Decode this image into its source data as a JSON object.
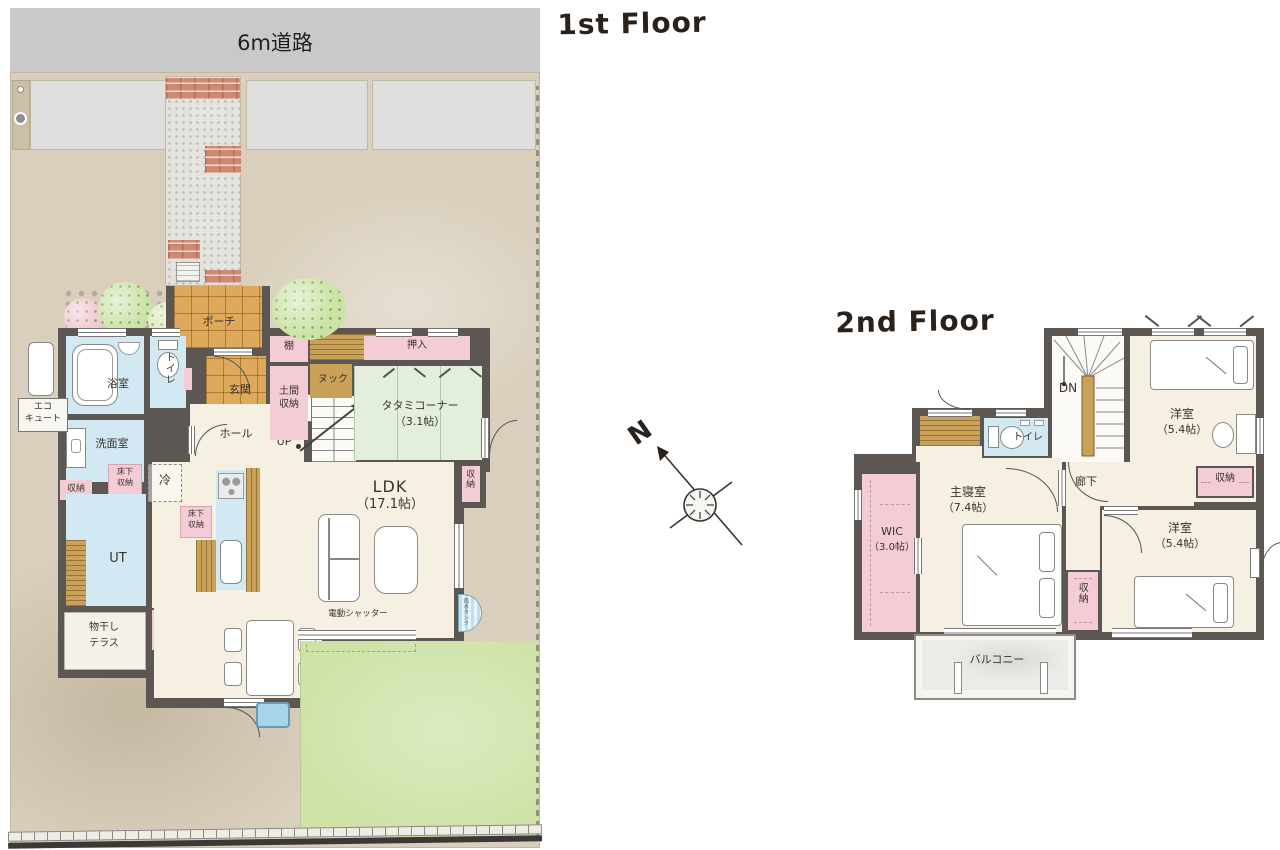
{
  "titles": {
    "floor1": "1st Floor",
    "floor2": "2nd Floor"
  },
  "site": {
    "road": "6m道路"
  },
  "colors": {
    "wall": "#5c5753",
    "water": "#d2e8f3",
    "closet_pink": "#f3ccd5",
    "tatami_green": "#e3efdc",
    "wood": "#c9a159",
    "lawn": "#cfe3a9",
    "road_gray": "#c9c9c9",
    "floor_cream": "#f6f0e2"
  },
  "f1": {
    "porch": "ポーチ",
    "genkan": "玄関",
    "tana": "棚",
    "doma_l1": "土間",
    "doma_l2": "収納",
    "nook": "ヌック",
    "oshiire": "押入",
    "tatami_name": "タタミコーナー",
    "tatami_size": "（3.1帖）",
    "bath": "浴室",
    "toilet": "トイレ",
    "wash": "洗面室",
    "hall": "ホール",
    "up": "UP",
    "ps": "PS",
    "shuno": "収納",
    "yukashita_l1": "床下",
    "yukashita_l2": "収納",
    "sen": "洗",
    "rei": "冷",
    "ut": "UT",
    "ldk_name": "LDK",
    "ldk_size": "（17.1帖）",
    "mono_l1": "物干し",
    "mono_l2": "テラス",
    "shutter": "電動シャッター",
    "eco_l1": "エコ",
    "eco_l2": "キュート",
    "rain": "雨水タンク"
  },
  "f2": {
    "dn": "DN",
    "yo1_name": "洋室",
    "yo1_size": "（5.4帖）",
    "toilet": "トイレ",
    "rouka": "廊下",
    "master_name": "主寝室",
    "master_size": "（7.4帖）",
    "wic_name": "WIC",
    "wic_size": "（3.0帖）",
    "shuno": "収納",
    "yo2_name": "洋室",
    "yo2_size": "（5.4帖）",
    "balcony": "バルコニー"
  },
  "compass": {
    "north": "N"
  }
}
